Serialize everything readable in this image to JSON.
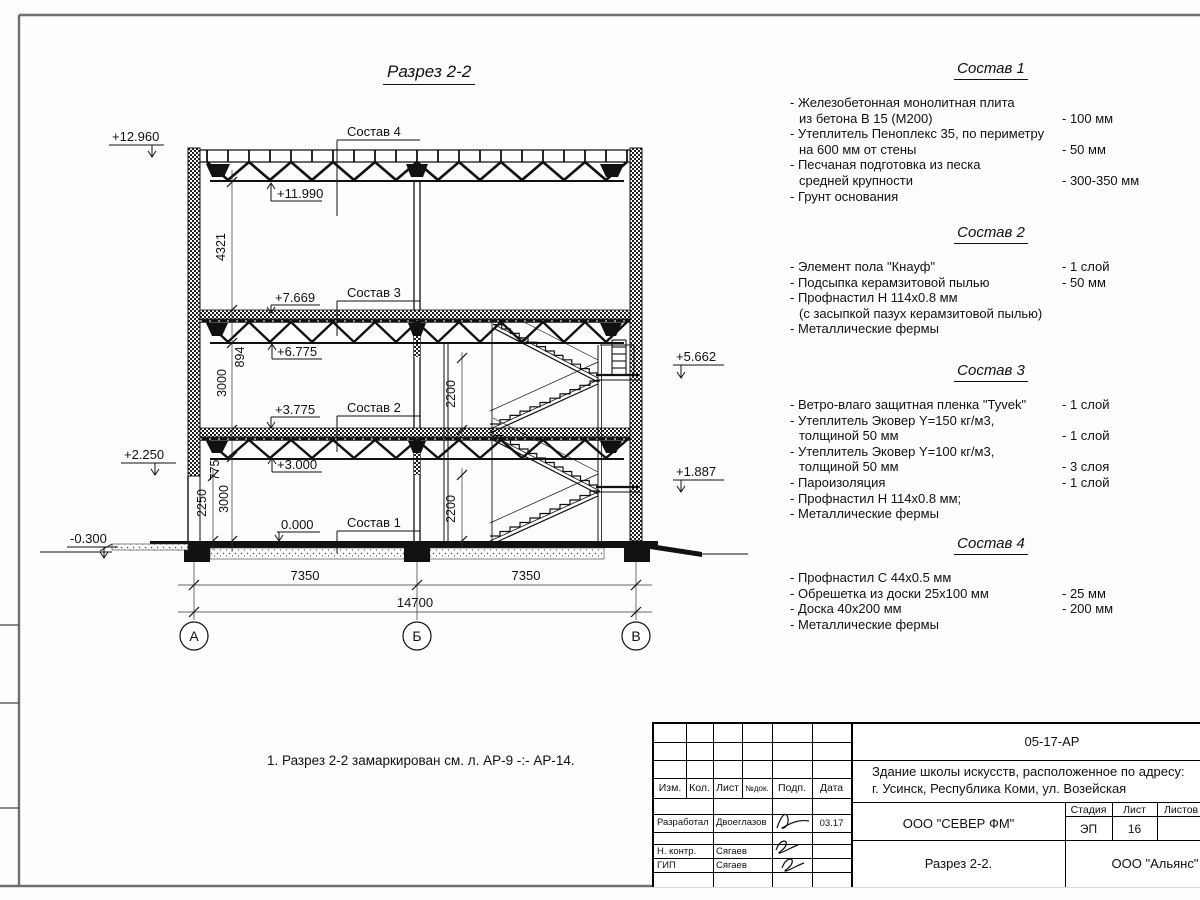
{
  "drawing": {
    "title": "Разрез 2-2",
    "note": "1. Разрез 2-2 замаркирован см. л. АР-9 -:- АР-14.",
    "sostav_labels": {
      "s4": "Состав 4",
      "s3": "Состав 3",
      "s2": "Состав 2",
      "s1": "Состав 1"
    },
    "elevations": {
      "parapet": "+12.960",
      "roof_bottom": "+11.990",
      "floor2_top": "+7.669",
      "floor2_bottom": "+6.775",
      "floor1_top": "+3.775",
      "floor1_bottom": "+3.000",
      "ground": "0.000",
      "left_mid": "+2.250",
      "left_base": "-0.300",
      "stair_upper": "+5.662",
      "stair_lower": "+1.887"
    },
    "dims": {
      "roof_space": "4321",
      "floor2_h": "894",
      "storey2": "3000",
      "floor1_h": "775",
      "storey1": "3000",
      "left_h": "2250",
      "stair_up": "2200",
      "stair_low": "2200",
      "span_ab": "7350",
      "span_bv": "7350",
      "total": "14700"
    },
    "axes": {
      "a": "А",
      "b": "Б",
      "v": "В"
    }
  },
  "compositions": [
    {
      "title": "Состав 1",
      "rows": [
        {
          "l": "- Железобетонная  монолитная плита",
          "r": ""
        },
        {
          "l": "из бетона В 15 (М200)",
          "r": "- 100 мм"
        },
        {
          "l": "- Утеплитель Пеноплекс 35, по периметру",
          "r": ""
        },
        {
          "l": "на 600 мм от стены",
          "r": "- 50 мм"
        },
        {
          "l": "- Песчаная подготовка из песка",
          "r": ""
        },
        {
          "l": "средней крупности",
          "r": "- 300-350 мм"
        },
        {
          "l": "- Грунт основания",
          "r": ""
        }
      ]
    },
    {
      "title": "Состав 2",
      "rows": [
        {
          "l": "- Элемент пола \"Кнауф\"",
          "r": "- 1 слой"
        },
        {
          "l": "- Подсыпка керамзитовой пылью",
          "r": "- 50 мм"
        },
        {
          "l": "- Профнастил Н 114х0.8 мм",
          "r": ""
        },
        {
          "l": "(с засыпкой пазух керамзитовой пылью)",
          "r": ""
        },
        {
          "l": "- Металлические фермы",
          "r": ""
        }
      ]
    },
    {
      "title": "Состав 3",
      "rows": [
        {
          "l": "- Ветро-влаго защитная пленка  \"Tyvek\"",
          "r": "- 1 слой"
        },
        {
          "l": "- Утеплитель Эковер Y=150 кг/м3,",
          "r": ""
        },
        {
          "l": "толщиной 50 мм",
          "r": "- 1 слой"
        },
        {
          "l": "- Утеплитель Эковер Y=100 кг/м3,",
          "r": ""
        },
        {
          "l": "толщиной 50 мм",
          "r": "- 3 слоя"
        },
        {
          "l": "- Пароизоляция",
          "r": "- 1 слой"
        },
        {
          "l": "- Профнастил Н 114х0.8 мм;",
          "r": ""
        },
        {
          "l": "- Металлические фермы",
          "r": ""
        }
      ]
    },
    {
      "title": "Состав 4",
      "rows": [
        {
          "l": "- Профнастил С 44х0.5 мм",
          "r": ""
        },
        {
          "l": "- Обрешетка из доски 25х100 мм",
          "r": "- 25 мм"
        },
        {
          "l": "- Доска 40х200 мм",
          "r": "- 200 мм"
        },
        {
          "l": "- Металлические фермы",
          "r": ""
        }
      ]
    }
  ],
  "titleblock": {
    "doc_code": "05-17-АР",
    "project_line1": "Здание школы искусств, расположенное по адресу:",
    "project_line2": "г. Усинск, Республика Коми, ул. Возейская",
    "org": "ООО \"СЕВЕР ФМ\"",
    "sheet_title": "Разрез 2-2.",
    "contractor": "ООО \"Альянс\"",
    "stage_label": "Стадия",
    "sheet_label": "Лист",
    "sheets_label": "Листов",
    "stage": "ЭП",
    "sheet_no": "16",
    "cols": {
      "izm": "Изм.",
      "kol": "Кол.",
      "list": "Лист",
      "ndok": "№док.",
      "podp": "Подп.",
      "data": "Дата"
    },
    "rows": [
      {
        "role": "Разработал",
        "name": "Двоеглазов",
        "date": "03.17"
      },
      {
        "role": "Н. контр.",
        "name": "Сягаев",
        "date": ""
      },
      {
        "role": "ГИП",
        "name": "Сягаев",
        "date": ""
      }
    ]
  }
}
